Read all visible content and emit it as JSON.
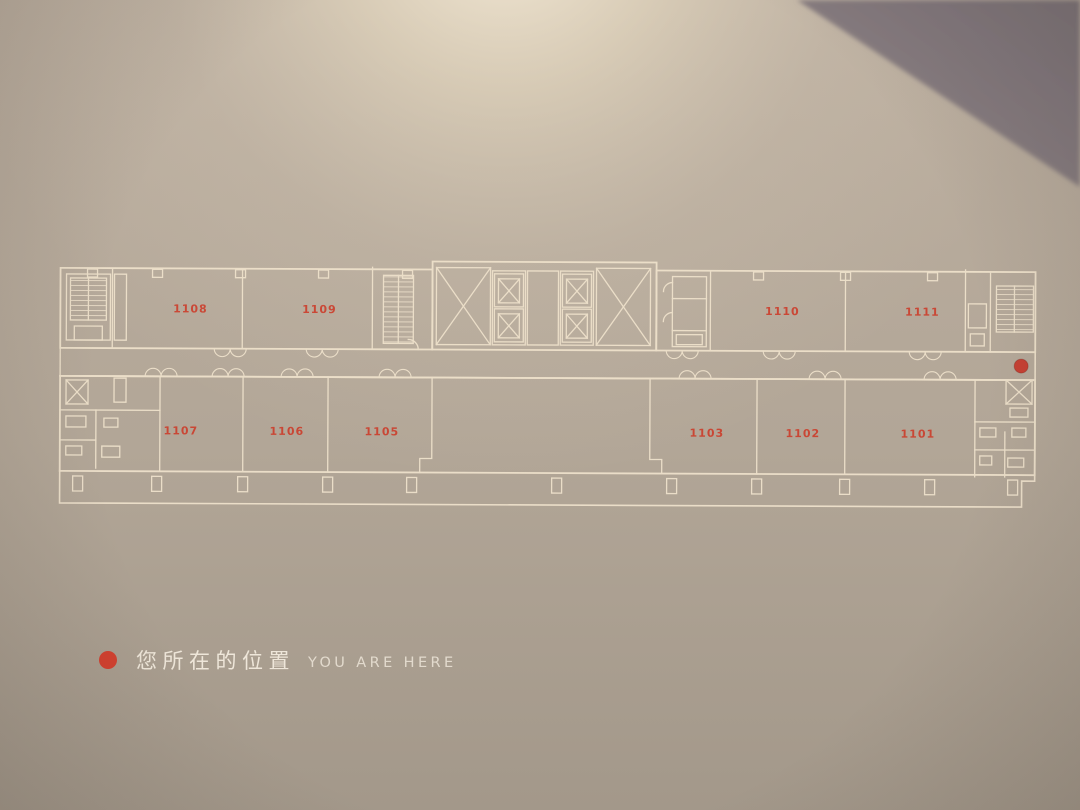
{
  "sign": {
    "floor_plan": {
      "rooms": [
        {
          "label": "1108",
          "x": 190,
          "y": 314
        },
        {
          "label": "1109",
          "x": 319,
          "y": 314
        },
        {
          "label": "1110",
          "x": 782,
          "y": 314
        },
        {
          "label": "1111",
          "x": 922,
          "y": 314
        },
        {
          "label": "1107",
          "x": 181,
          "y": 436
        },
        {
          "label": "1106",
          "x": 287,
          "y": 436
        },
        {
          "label": "1105",
          "x": 382,
          "y": 436
        },
        {
          "label": "1103",
          "x": 707,
          "y": 436
        },
        {
          "label": "1102",
          "x": 803,
          "y": 436
        },
        {
          "label": "1101",
          "x": 918,
          "y": 436
        }
      ],
      "you_are_here_marker": {
        "x": 1021,
        "y": 364
      }
    },
    "legend": {
      "label_zh": "您所在的位置",
      "label_en": "YOU ARE HERE"
    },
    "colors": {
      "room_number": "#cd3a28",
      "marker_red": "#c63b2e",
      "legend_dot": "#d2402f",
      "legend_text_zh": "#f2eadd",
      "legend_text_en": "#e9e1d4",
      "plan_line": "#eee1cb"
    }
  }
}
